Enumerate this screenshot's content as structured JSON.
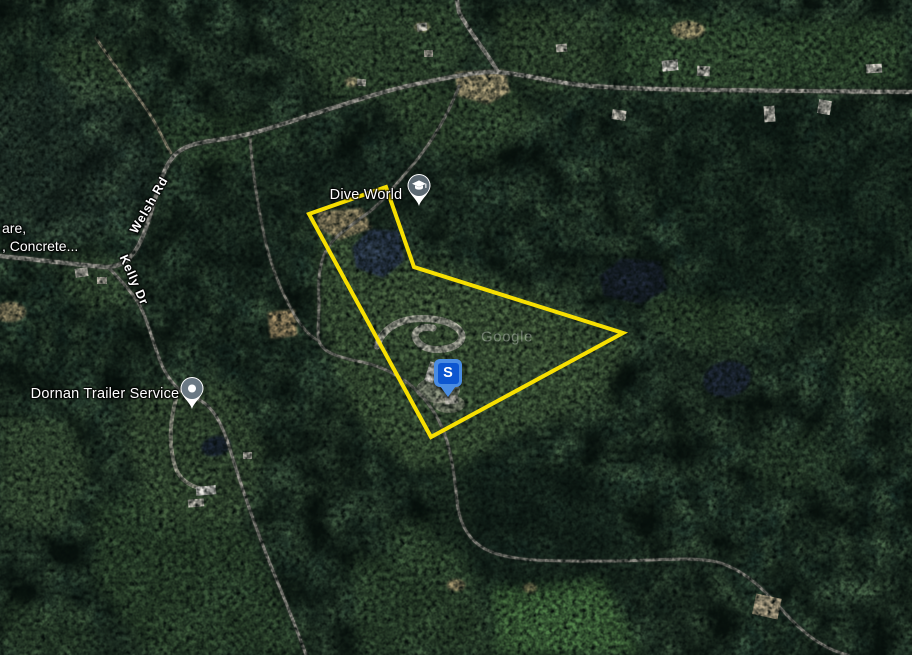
{
  "watermark": {
    "text": "Google",
    "x": 507,
    "y": 337
  },
  "parcel": {
    "color": "#FFE600",
    "points": "386,187 309,214 431,437 623,333 414,267"
  },
  "subject_marker": {
    "label": "S",
    "x": 448,
    "y": 397
  },
  "pois": [
    {
      "name": "Dive World",
      "pin": {
        "x": 419,
        "y": 207
      },
      "label_pos": {
        "x": 366,
        "y": 195
      }
    },
    {
      "name": "Dornan Trailer Service",
      "pin": {
        "x": 192,
        "y": 410
      },
      "label_pos": {
        "x": 105,
        "y": 394
      }
    }
  ],
  "road_labels": [
    {
      "text": "Welsh Rd",
      "x": 149,
      "y": 205,
      "rotation": -60
    },
    {
      "text": "Kelly Dr",
      "x": 134,
      "y": 280,
      "rotation": 66
    }
  ],
  "edge_label": {
    "line1": "are,",
    "line2": ", Concrete...",
    "x": 2,
    "y": 219
  }
}
